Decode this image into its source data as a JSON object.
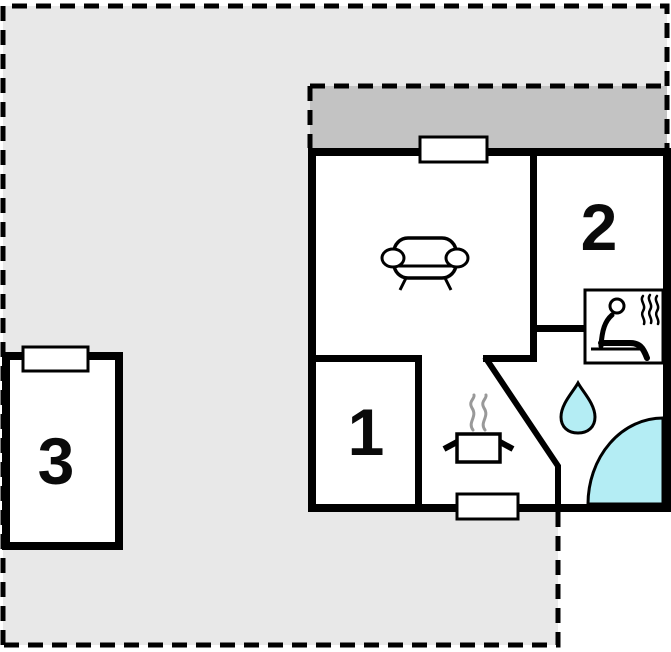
{
  "rooms": [
    {
      "id": "room-1",
      "label": "1"
    },
    {
      "id": "room-2",
      "label": "2"
    },
    {
      "id": "room-3",
      "label": "3"
    }
  ],
  "icons": {
    "sofa": "sofa-icon",
    "sauna": "sauna-person-icon",
    "kitchen": "cooking-pot-icon",
    "bathroom": "water-drop-icon",
    "shower": "shower-quarter-circle-icon",
    "steam": "steam-waves-icon"
  },
  "colors": {
    "plot_area": "#e8e8e8",
    "terrace": "#c3c3c3",
    "water": "#b4edf4",
    "wall": "#000000",
    "steam": "#999999"
  }
}
